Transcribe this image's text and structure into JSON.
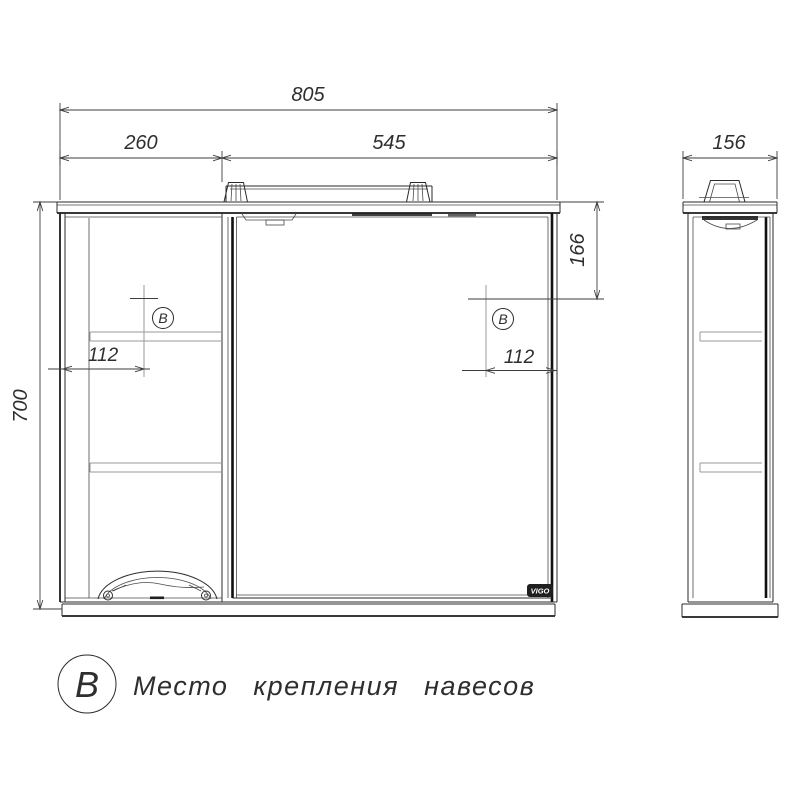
{
  "dimensions": {
    "overall_width": "805",
    "left_section_width": "260",
    "right_section_width": "545",
    "depth": "156",
    "height": "700",
    "hanger_vertical_offset": "166",
    "hanger_offset_left": "112",
    "hanger_offset_right": "112"
  },
  "markers": {
    "left": "В",
    "right": "В"
  },
  "legend": {
    "symbol": "В",
    "description": "Место крепления навесов"
  },
  "badge": {
    "text": "VIGO"
  },
  "colors": {
    "background": "#ffffff",
    "outline": "#2b2b2b",
    "mirror_edge": "#101010",
    "dimension": "#3d3d3d",
    "construction": "#9a9a9a"
  }
}
